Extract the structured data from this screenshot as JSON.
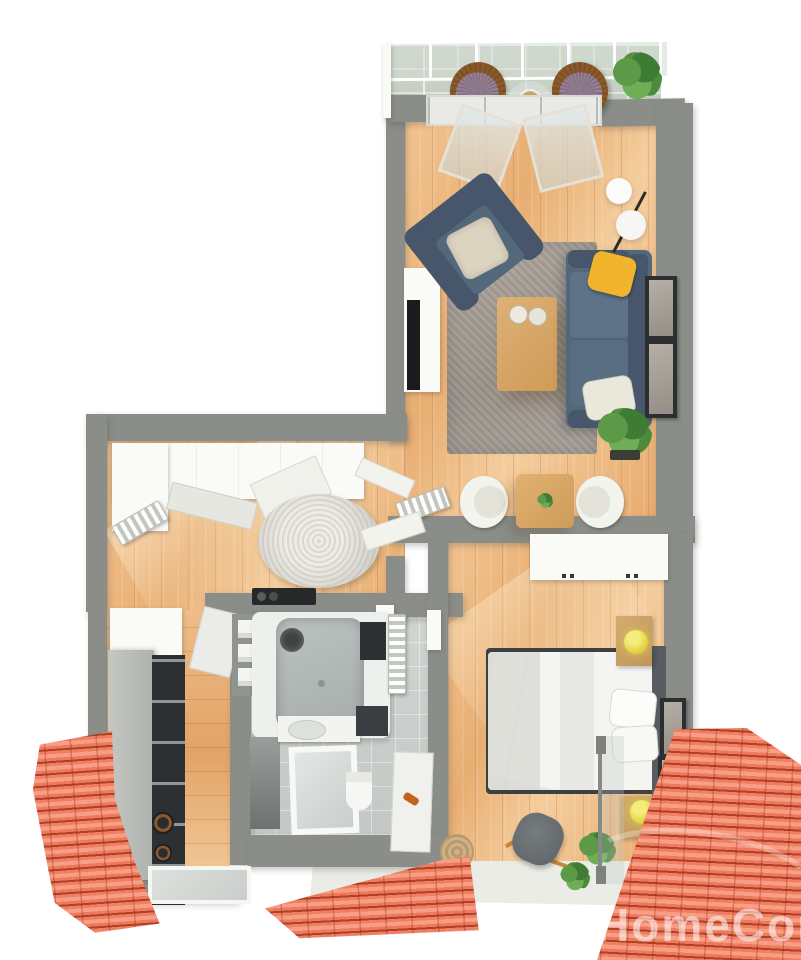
{
  "meta": {
    "type": "3d-floor-plan-render",
    "view": "top-down isometric",
    "description": "One-bedroom attic apartment 3D floor plan with balcony, living room, dining nook, hallway, kitchen, bathroom, bedroom and rear terrace, surrounded by red tiled roofs",
    "watermark": "HomeCom"
  },
  "palette": {
    "background": "#ffffff",
    "wall": "#8b8e88",
    "wood_floor": "#eab57f",
    "wood_floor_light": "#f4cd9d",
    "roof_tile": "#ee7f63",
    "roof_ridge": "#a83218",
    "sofa_upholstery": "#54687c",
    "accent_pillow_yellow": "#f1b42c",
    "pillow_beige": "#dcd4c0",
    "living_rug": "#a9a29b",
    "hall_rug": "#e8e6e0",
    "bathroom_floor": "#ced3d0",
    "balcony_floor": "#cad1c5",
    "kitchen_unit_dark": "#2d3032",
    "lamp_yellow": "#e6d748",
    "plant_green": "#55903f",
    "bed_linen": "#f4f4f1",
    "table_wood": "#d8a966"
  },
  "rooms": {
    "balcony": {
      "name": "balcony",
      "items": [
        "railing with glass panels",
        "wicker chair with purple cushion",
        "wicker chair with purple cushion",
        "round glass table",
        "potted palm"
      ]
    },
    "living_room": {
      "name": "living room",
      "items": [
        "open glass balcony door",
        "armchair with beige cushion",
        "gray area rug",
        "wood coffee table with two plates",
        "sofa with yellow and white pillows",
        "two wall art frames",
        "double globe floor lamp",
        "tv sideboard",
        "tv",
        "radiator",
        "floor plant"
      ]
    },
    "dining_nook": {
      "name": "dining nook",
      "items": [
        "square wood table with plant",
        "white shell chair",
        "white shell chair",
        "radiator"
      ]
    },
    "hallway": {
      "name": "hallway",
      "items": [
        "white wardrobe",
        "open wardrobe doors",
        "round fluffy rug",
        "radiator",
        "black console",
        "open double doors to living room"
      ]
    },
    "kitchen": {
      "name": "kitchen",
      "items": [
        "white counter block",
        "gray cabinet run",
        "tall dark unit",
        "cooktop burners",
        "open cabinet door",
        "window"
      ]
    },
    "bathroom": {
      "name": "bathroom",
      "items": [
        "towel niches",
        "bathtub",
        "shower head",
        "dark cabinet",
        "towel radiator",
        "washing machine",
        "sink counter",
        "framed window",
        "white door panel with orange handle",
        "toilet",
        "dark floor mat"
      ]
    },
    "bedroom": {
      "name": "bedroom",
      "items": [
        "white wardrobe",
        "double bed with white duvet",
        "headboard",
        "two pillows",
        "nightstand with yellow lamp",
        "nightstand with yellow lamp",
        "two wall art frames",
        "gray lounge chair",
        "plant",
        "jute rug",
        "basket",
        "glass partition"
      ]
    },
    "terrace": {
      "name": "terrace",
      "items": [
        "light floor",
        "plant"
      ]
    },
    "exterior": {
      "name": "exterior",
      "items": [
        "red tiled roof left",
        "red tiled roof bottom",
        "red tiled roof right"
      ]
    }
  }
}
